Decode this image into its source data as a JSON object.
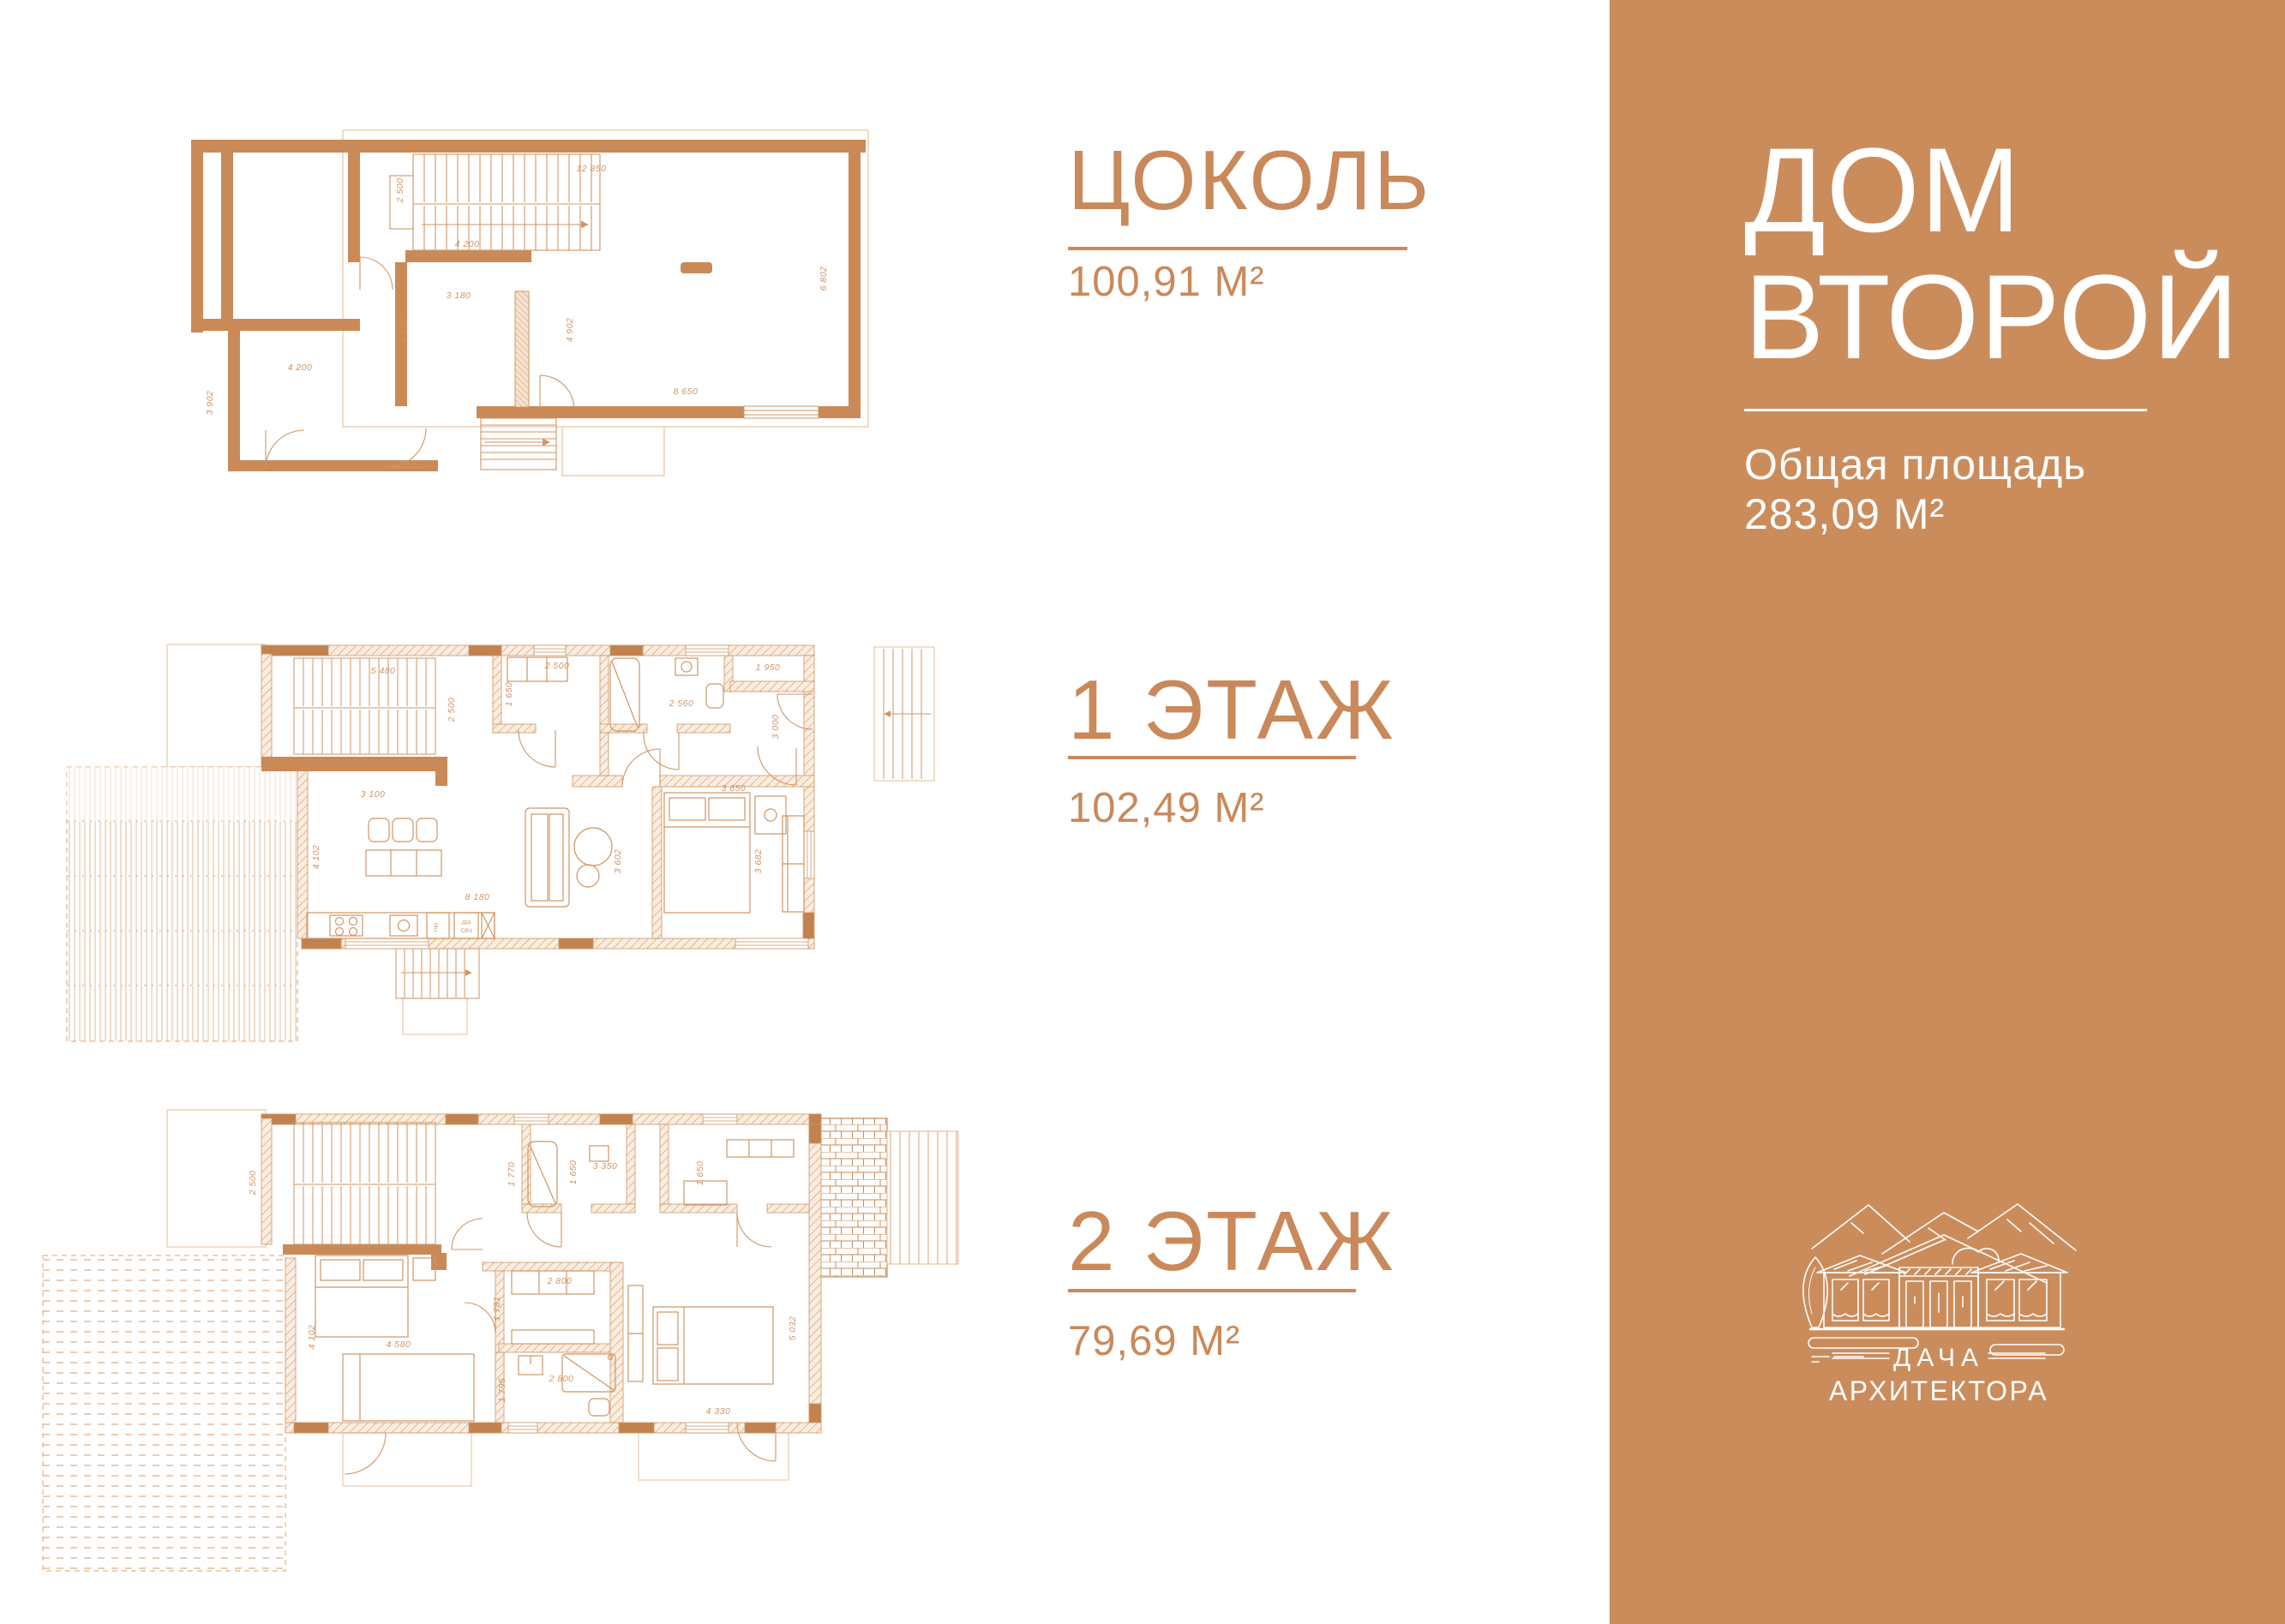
{
  "page": {
    "accent_color": "#C9895B",
    "sidebar_background": "#CB8C5C",
    "wall_color": "#C98A58"
  },
  "floors": [
    {
      "label": "ЦОКОЛЬ",
      "area": "100,91 М²"
    },
    {
      "label": "1 ЭТАЖ",
      "area": "102,49 М²"
    },
    {
      "label": "2 ЭТАЖ",
      "area": "79,69 М²"
    }
  ],
  "sidebar": {
    "title_line1": "ДОМ",
    "title_line2": "ВТОРОЙ",
    "total_area_label": "Общая площадь",
    "total_area_value": "283,09 М²",
    "logo": {
      "line1": "ДАЧА",
      "line2": "АРХИТЕКТОРА"
    }
  },
  "plans": {
    "basement": {
      "dims": [
        "12 850",
        "2 500",
        "4 200",
        "3 180",
        "4 102",
        "4 902",
        "6 802",
        "8 650",
        "4 200",
        "3 902"
      ]
    },
    "floor1": {
      "dims": [
        "5 480",
        "2 500",
        "2 500",
        "1 650",
        "2 560",
        "1 950",
        "3 000",
        "3 100",
        "4 102",
        "8 180",
        "3 602",
        "3 682",
        "3 650"
      ],
      "kitchen_labels": [
        "ПМ",
        "ДШ",
        "СВЧ"
      ]
    },
    "floor2": {
      "dims": [
        "2 500",
        "1 770",
        "1 650",
        "3 350",
        "1 650",
        "2 800",
        "1 781",
        "4 580",
        "4 102",
        "2 800",
        "1 795",
        "5 032",
        "4 330"
      ]
    }
  }
}
